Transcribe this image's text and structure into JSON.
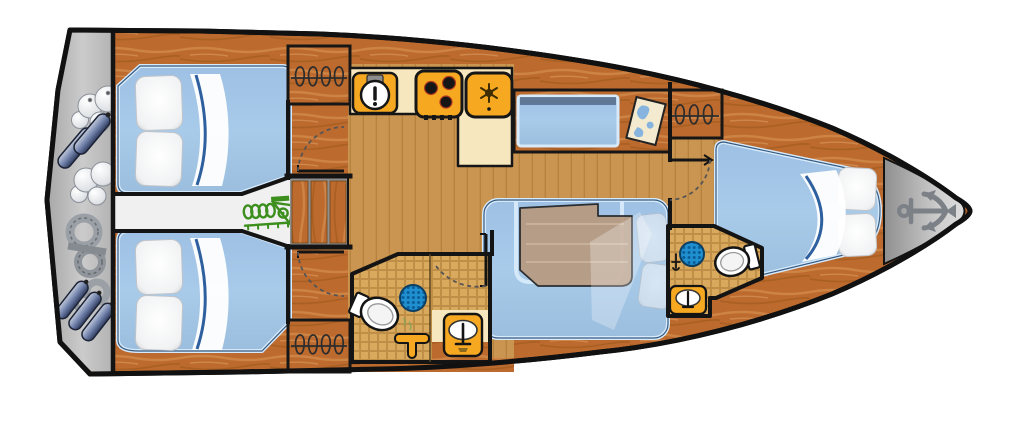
{
  "title": "sailing-yacht-interior-floor-plan",
  "orientation": {
    "bow": "right",
    "stern": "left",
    "view": "top-down deck plan"
  },
  "colors": {
    "deck_wood": "#bc6a2e",
    "deck_grain_light": "#d6914f",
    "deck_grain_dark": "#9a5518",
    "floor_wood": "#c99551",
    "floor_plank_line": "#a06c2b",
    "counter_cream": "#f6e7bf",
    "appliance_orange": "#f6a821",
    "bed_blue": "#a9cbea",
    "bed_border": "#d7eafb",
    "bed_edge_dark": "#35597f",
    "corridor_white": "#f0f0f0",
    "transom_gray": "#bdbdbd",
    "bow_gray": "#b5b5b5",
    "wall_black": "#141414",
    "engine_green": "#3c8f1d",
    "drain_blue": "#1f8fd0",
    "drain_dot": "#0b5d97",
    "table_wood": "#b79a80",
    "tile_grout": "#c08f47",
    "tile_cell": "#d9a95e",
    "map_paper": "#f3ead0",
    "map_blue": "#86b4df",
    "anchor_gray": "#7c8187",
    "stair_gap_gray": "#8f8f8f",
    "fender_navy": "#3c4a72",
    "rope_gray": "#9aa0a6"
  },
  "rooms": [
    {
      "id": "stern-lazarette",
      "name": "transom stowage",
      "features": [
        "fenders",
        "mooring buoys",
        "coiled ropes"
      ]
    },
    {
      "id": "aft-cabin-upper",
      "name": "aft double cabin (top)",
      "features": [
        "double berth",
        "two pillows",
        "folded sheet"
      ]
    },
    {
      "id": "aft-cabin-lower",
      "name": "aft double cabin (bottom)",
      "features": [
        "double berth",
        "two pillows",
        "folded sheet"
      ]
    },
    {
      "id": "engine-corridor",
      "name": "engine compartment passage",
      "features": [
        "engine"
      ]
    },
    {
      "id": "companionway",
      "name": "companionway steps",
      "features": [
        "three wooden steps"
      ]
    },
    {
      "id": "wardrobe-top",
      "name": "hanging locker (galley side)",
      "features": [
        "clothes hangers"
      ]
    },
    {
      "id": "wardrobe-bottom",
      "name": "hanging locker (aft head side)",
      "features": [
        "clothes hangers"
      ]
    },
    {
      "id": "wardrobe-forward",
      "name": "hanging locker (forward cabin)",
      "features": [
        "clothes hangers"
      ]
    },
    {
      "id": "galley",
      "name": "galley",
      "features": [
        "round sink",
        "three-burner stove",
        "refrigerator",
        "L-shaped counter"
      ]
    },
    {
      "id": "nav-station",
      "name": "navigation station",
      "features": [
        "seat",
        "chart table",
        "sea chart"
      ]
    },
    {
      "id": "salon",
      "name": "salon",
      "features": [
        "U-shaped settee",
        "wooden table",
        "loose cushions"
      ]
    },
    {
      "id": "aft-head",
      "name": "aft head / shower",
      "features": [
        "toilet",
        "shower drain",
        "mixer tap",
        "washbasin"
      ]
    },
    {
      "id": "forward-head",
      "name": "forward head",
      "features": [
        "toilet",
        "shower drain",
        "washbasin",
        "faucet"
      ]
    },
    {
      "id": "forward-cabin",
      "name": "forward V-berth cabin",
      "features": [
        "V-berth",
        "two pillows",
        "folded sheet"
      ]
    },
    {
      "id": "bow-locker",
      "name": "anchor locker / bow",
      "features": [
        "anchor"
      ]
    }
  ],
  "icons": [
    {
      "name": "anchor-icon",
      "meaning": "anchor locker at bow"
    },
    {
      "name": "engine-icon",
      "meaning": "engine location"
    },
    {
      "name": "map-icon",
      "meaning": "chart table"
    },
    {
      "name": "snowflake-icon",
      "meaning": "refrigerator"
    },
    {
      "name": "stove-icon",
      "meaning": "three-burner hob"
    },
    {
      "name": "sink-icon",
      "meaning": "galley sink"
    },
    {
      "name": "shower-drain-icon",
      "meaning": "shower place"
    },
    {
      "name": "toilet-icon",
      "meaning": "marine toilet"
    },
    {
      "name": "washbasin-icon",
      "meaning": "washbasin"
    },
    {
      "name": "hanger-icon",
      "meaning": "hanging wardrobe"
    },
    {
      "name": "fender-icon",
      "meaning": "stowed fenders"
    },
    {
      "name": "buoy-icon",
      "meaning": "stowed buoys"
    },
    {
      "name": "rope-icon",
      "meaning": "stowed mooring lines"
    },
    {
      "name": "door-swing-arc",
      "meaning": "door opening direction"
    }
  ],
  "counts": {
    "cabins": 3,
    "heads": 2,
    "berth_pillows": 6,
    "stove_burners": 3,
    "companionway_steps": 3,
    "hanging_lockers": 3
  }
}
